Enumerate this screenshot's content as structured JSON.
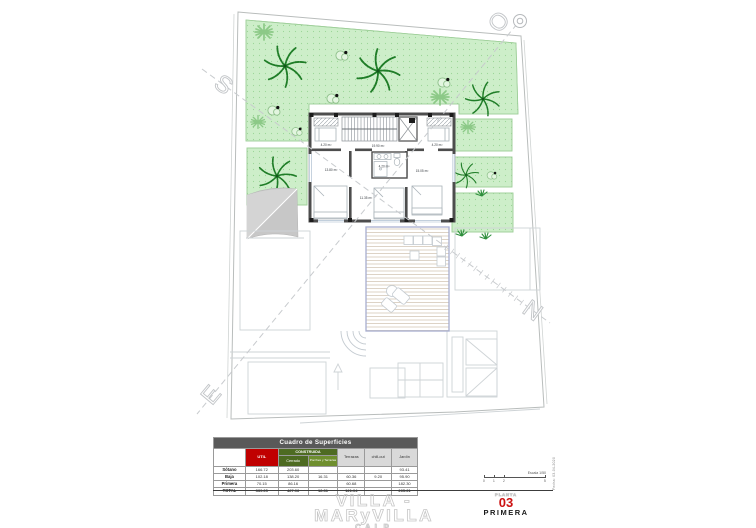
{
  "plan": {
    "compass": {
      "s": "S",
      "o": "O",
      "n": "N",
      "e": "E"
    },
    "labels": {
      "closet_left": "4.20 m²",
      "closet_right": "4.20 m²",
      "hall": "19.90 m²",
      "bath": "4.20 m²",
      "bed_left": "13.80 m²",
      "bed_mid": "11.35 m²",
      "bed_right": "15.05 m²"
    }
  },
  "table": {
    "title": "Cuadro de Superficies",
    "headers": {
      "util": "UTIL",
      "construida": "CONSTRUIDA",
      "cerrado": "Cerrado",
      "porches": "Porches y Terrazas",
      "terrazas": "Terrazas",
      "chillout": "chill-out",
      "jardin": "Jardín"
    },
    "rows": [
      {
        "label": "Sótano",
        "util": "166.72",
        "cerrado": "203.60",
        "porches": "",
        "terrazas": "",
        "chillout": "",
        "jardin": "93.41"
      },
      {
        "label": "Baja",
        "util": "102.18",
        "cerrado": "138.20",
        "porches": "16.31",
        "terrazas": "60.36",
        "chillout": "9.20",
        "jardin": "95.90"
      },
      {
        "label": "Primera",
        "util": "70.15",
        "cerrado": "86.16",
        "porches": "",
        "terrazas": "60.68",
        "chillout": "",
        "jardin": "182.30"
      },
      {
        "label": "TOTAL",
        "util": "339.05",
        "cerrado": "427.96",
        "porches": "16.31",
        "terrazas": "121.04",
        "chillout": "",
        "jardin": "265.21"
      }
    ]
  },
  "footer": {
    "project": "VILLA - MARyVILLA",
    "location": "CALP",
    "planta_label": "PLANTA",
    "planta_number": "03",
    "planta_name": "PRIMERA",
    "escala": "Escala 1/50",
    "fecha": "Fecha: 03-04-2020",
    "ticks": [
      "0",
      "1",
      "2",
      "5"
    ]
  }
}
